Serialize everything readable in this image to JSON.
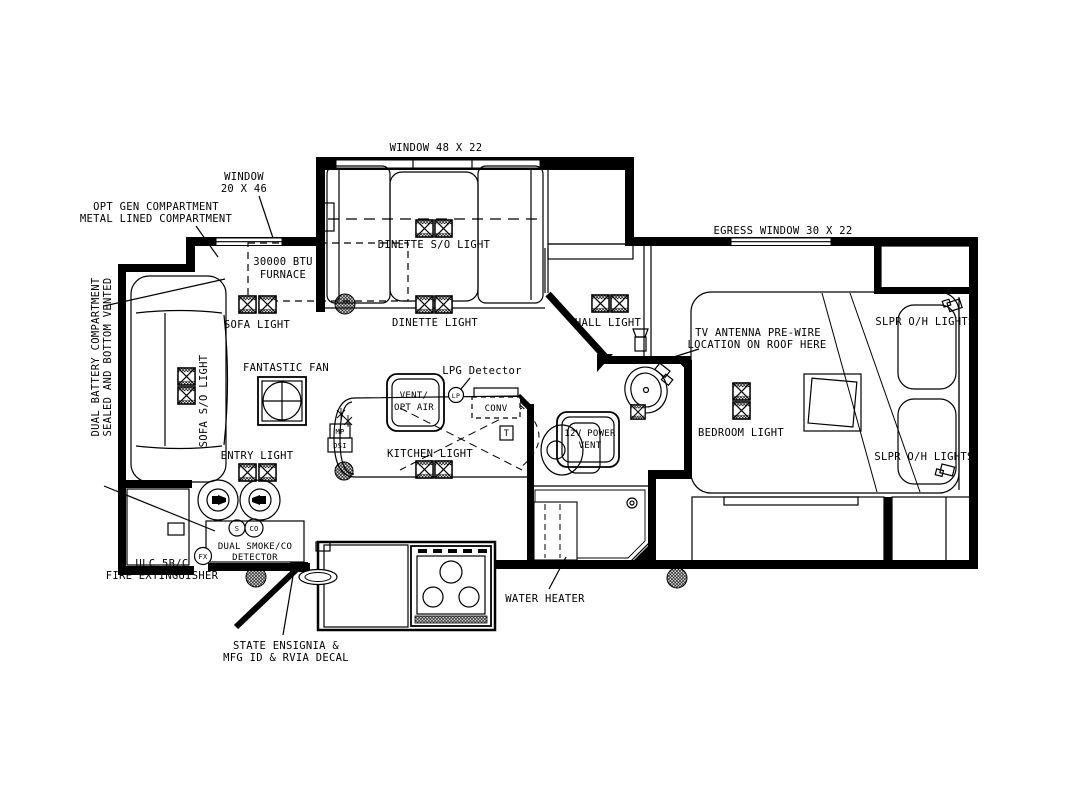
{
  "title": "RV travel trailer floor plan",
  "colors": {
    "ink": "#000000",
    "paper": "#ffffff"
  },
  "labels": {
    "window_48": "WINDOW 48 X 22",
    "window_20_l1": "WINDOW",
    "window_20_l2": "20 X 46",
    "opt_gen_l1": "OPT GEN COMPARTMENT",
    "opt_gen_l2": "METAL LINED COMPARTMENT",
    "dual_battery_l1": "DUAL BATTERY COMPARTMENT",
    "dual_battery_l2": "SEALED AND BOTTOM VENTED",
    "furnace_l1": "30000 BTU",
    "furnace_l2": "FURNACE",
    "sofa_light": "SOFA LIGHT",
    "dinette_so_light": "DINETTE S/O LIGHT",
    "dinette_light": "DINETTE LIGHT",
    "hall_light": "HALL LIGHT",
    "egress_window": "EGRESS WINDOW 30 X 22",
    "tv_antenna_l1": "TV ANTENNA PRE-WIRE",
    "tv_antenna_l2": "LOCATION ON ROOF HERE",
    "slpr_oh_top": "SLPR O/H LIGHTS",
    "slpr_oh_bottom": "SLPR O/H LIGHTS",
    "sofa_so_light": "SOFA S/O LIGHT",
    "fantastic_fan": "FANTASTIC FAN",
    "lpg_detector": "LPG Detector",
    "vent_opt_air_l1": "VENT/",
    "vent_opt_air_l2": "OPT AIR",
    "conv": "CONV",
    "bedroom_light": "BEDROOM LIGHT",
    "kitchen_light": "KITCHEN LIGHT",
    "power_vent_l1": "12V POWER",
    "power_vent_l2": "VENT",
    "entry_light": "ENTRY LIGHT",
    "smoke_l1": "DUAL SMOKE/CO",
    "smoke_l2": "DETECTOR",
    "ulc_l1": "ULC 5B/C",
    "ulc_l2": "FIRE EXTINGUISHER",
    "water_heater": "WATER HEATER",
    "ensignia_l1": "STATE ENSIGNIA &",
    "ensignia_l2": "MFG ID & RVIA DECAL"
  },
  "badges": {
    "smoke": "S",
    "co": "CO",
    "fire_ext": "FX",
    "lpg": "LP",
    "thermostat": "T",
    "monitor_panel": "MP",
    "dsi": "DSI"
  }
}
